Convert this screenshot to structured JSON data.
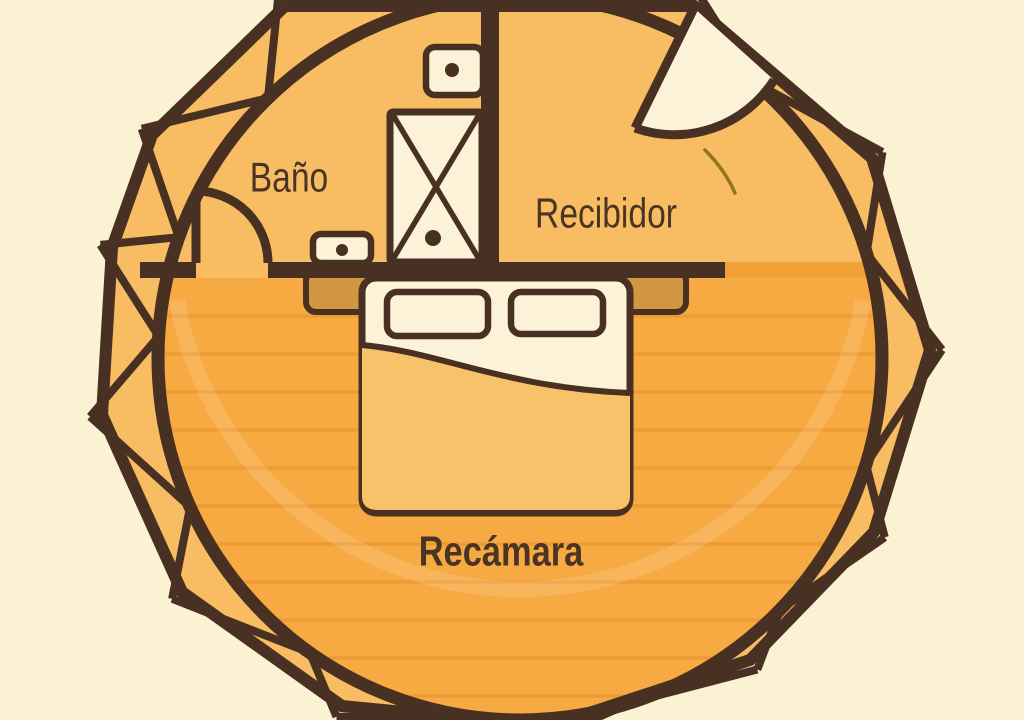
{
  "rooms": {
    "bathroom": {
      "label": "Baño"
    },
    "entry_hall": {
      "label": "Recibidor"
    },
    "bedroom": {
      "label": "Recámara"
    }
  },
  "fixtures": {
    "bed": "double-bed-icon",
    "pillows": "pillow-icon",
    "shower": "shower-icon",
    "toilet": "toilet-icon",
    "sink": "sink-icon",
    "bathroom_door": "door-swing-icon",
    "entrance_door": "door-swing-icon"
  },
  "colors": {
    "background": "#FBF1D3",
    "line_brown": "#483122",
    "room_floor": "#F8BD63",
    "bedroom_floor": "#F7A942",
    "plank_line": "#E8912A",
    "threshold_strip": "#EFA037",
    "cream": "#FBF2D7",
    "furniture_tan": "#D29540",
    "blanket": "#F8C26A",
    "accent_olive": "#95731F",
    "label_text": "#4A3424"
  }
}
